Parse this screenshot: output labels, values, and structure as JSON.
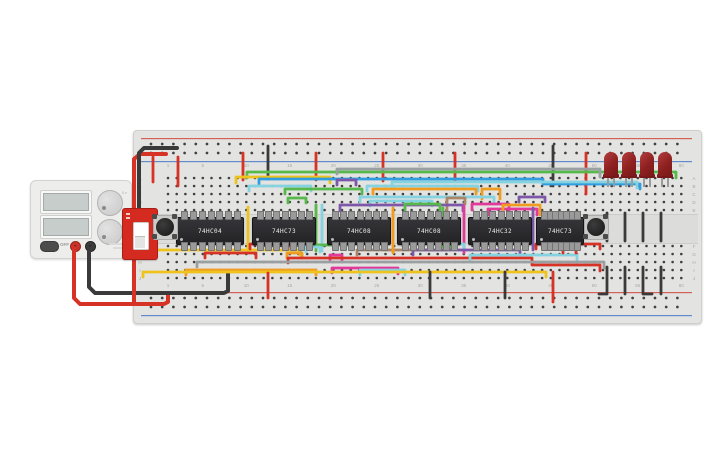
{
  "canvas": {
    "width": 725,
    "height": 453,
    "background": "#ffffff"
  },
  "power_supply": {
    "off_label": "OFF",
    "knobs": [
      {
        "name": "voltage-knob",
        "min": "0 v",
        "max": "30 v"
      },
      {
        "name": "current-knob",
        "min": "0 a",
        "max": "2 a"
      }
    ],
    "screens": [
      {
        "value": ""
      },
      {
        "value": ""
      }
    ],
    "terminals": [
      {
        "name": "positive",
        "color": "#c8322b"
      },
      {
        "name": "negative",
        "color": "#3c3c3c"
      }
    ]
  },
  "slide_switch": {
    "color": "#d42a20",
    "state": "down"
  },
  "board": {
    "column_numbers": [
      1,
      5,
      10,
      15,
      20,
      25,
      30,
      35,
      40,
      45,
      50,
      55,
      60
    ],
    "row_letters_top": [
      "A",
      "B",
      "C",
      "D",
      "E"
    ],
    "row_letters_bottom": [
      "F",
      "G",
      "H",
      "I",
      "J"
    ],
    "rail_plus_color": "#cf4a3f",
    "rail_minus_color": "#4a7bc9"
  },
  "ics": [
    {
      "label": "74HC04",
      "x": 176,
      "w": 66
    },
    {
      "label": "74HC73",
      "x": 252,
      "w": 62
    },
    {
      "label": "74HC08",
      "x": 327,
      "w": 62
    },
    {
      "label": "74HC08",
      "x": 397,
      "w": 62
    },
    {
      "label": "74HC32",
      "x": 468,
      "w": 62
    },
    {
      "label": "74HC73",
      "x": 536,
      "w": 46
    }
  ],
  "pushbuttons": [
    {
      "x": 152
    },
    {
      "x": 583
    }
  ],
  "leds": {
    "color": "#8e2020",
    "x_positions": [
      604,
      622,
      640,
      658
    ]
  },
  "wire_colors": {
    "red": "#d63226",
    "black": "#3a3a3a",
    "yellow": "#eec31e",
    "orange": "#f09c21",
    "green": "#57b94c",
    "blue": "#2f9de0",
    "cyan": "#85d2e0",
    "purple": "#7e57a8",
    "magenta": "#e23a9b",
    "brown": "#ad8566",
    "gray": "#9aa0a2"
  },
  "wires": [
    {
      "c": "red",
      "w": 4,
      "p": [
        [
          74,
          248
        ],
        [
          74,
          298
        ],
        [
          80,
          304
        ],
        [
          164,
          304
        ],
        [
          168,
          302
        ],
        [
          168,
          296
        ]
      ]
    },
    {
      "c": "black",
      "w": 4,
      "p": [
        [
          89,
          248
        ],
        [
          89,
          287
        ],
        [
          95,
          293
        ],
        [
          224,
          293
        ],
        [
          228,
          291
        ],
        [
          228,
          271
        ]
      ]
    },
    {
      "c": "red",
      "w": 4,
      "p": [
        [
          166,
          154
        ],
        [
          140,
          154
        ],
        [
          134,
          159
        ],
        [
          134,
          303
        ]
      ]
    },
    {
      "c": "black",
      "w": 4,
      "p": [
        [
          177,
          148
        ],
        [
          144,
          148
        ],
        [
          139,
          153
        ],
        [
          139,
          254
        ]
      ]
    },
    {
      "c": "red",
      "p": [
        [
          153,
          157
        ],
        [
          153,
          182
        ]
      ]
    },
    {
      "c": "red",
      "p": [
        [
          178,
          157
        ],
        [
          178,
          186
        ]
      ]
    },
    {
      "c": "red",
      "p": [
        [
          243,
          153
        ],
        [
          243,
          180
        ]
      ]
    },
    {
      "c": "red",
      "p": [
        [
          316,
          153
        ],
        [
          316,
          180
        ]
      ]
    },
    {
      "c": "red",
      "p": [
        [
          383,
          153
        ],
        [
          383,
          181
        ]
      ]
    },
    {
      "c": "red",
      "p": [
        [
          455,
          153
        ],
        [
          455,
          181
        ]
      ]
    },
    {
      "c": "red",
      "p": [
        [
          586,
          153
        ],
        [
          586,
          194
        ]
      ]
    },
    {
      "c": "black",
      "p": [
        [
          268,
          146
        ],
        [
          268,
          179
        ]
      ]
    },
    {
      "c": "black",
      "p": [
        [
          553,
          146
        ],
        [
          553,
          186
        ]
      ]
    },
    {
      "c": "green",
      "p": [
        [
          247,
          178
        ],
        [
          247,
          172
        ],
        [
          676,
          172
        ],
        [
          676,
          178
        ]
      ]
    },
    {
      "c": "gray",
      "p": [
        [
          337,
          174
        ],
        [
          337,
          169
        ],
        [
          600,
          169
        ],
        [
          600,
          177
        ]
      ]
    },
    {
      "c": "yellow",
      "p": [
        [
          236,
          183
        ],
        [
          236,
          177
        ],
        [
          330,
          177
        ],
        [
          330,
          183
        ]
      ]
    },
    {
      "c": "blue",
      "p": [
        [
          259,
          185
        ],
        [
          259,
          179
        ],
        [
          543,
          179
        ],
        [
          543,
          184
        ],
        [
          640,
          184
        ],
        [
          640,
          189
        ]
      ]
    },
    {
      "c": "cyan",
      "p": [
        [
          392,
          188
        ],
        [
          392,
          182
        ],
        [
          637,
          182
        ],
        [
          637,
          188
        ]
      ]
    },
    {
      "c": "cyan",
      "p": [
        [
          249,
          191
        ],
        [
          249,
          186
        ],
        [
          311,
          186
        ],
        [
          311,
          191
        ]
      ]
    },
    {
      "c": "green",
      "p": [
        [
          285,
          194
        ],
        [
          285,
          189
        ],
        [
          362,
          189
        ],
        [
          362,
          194
        ]
      ]
    },
    {
      "c": "purple",
      "p": [
        [
          337,
          185
        ],
        [
          337,
          180
        ],
        [
          356,
          180
        ],
        [
          356,
          185
        ]
      ]
    },
    {
      "c": "cyan",
      "p": [
        [
          367,
          191
        ],
        [
          367,
          186
        ],
        [
          478,
          186
        ],
        [
          478,
          191
        ]
      ]
    },
    {
      "c": "orange",
      "p": [
        [
          373,
          194
        ],
        [
          373,
          189
        ],
        [
          476,
          189
        ],
        [
          476,
          194
        ]
      ]
    },
    {
      "c": "orange",
      "p": [
        [
          482,
          199
        ],
        [
          482,
          189
        ],
        [
          500,
          189
        ],
        [
          500,
          199
        ]
      ]
    },
    {
      "c": "cyan",
      "p": [
        [
          360,
          202
        ],
        [
          360,
          197
        ],
        [
          494,
          197
        ],
        [
          494,
          202
        ]
      ]
    },
    {
      "c": "purple",
      "p": [
        [
          519,
          202
        ],
        [
          519,
          197
        ],
        [
          545,
          197
        ],
        [
          545,
          202
        ]
      ]
    },
    {
      "c": "green",
      "p": [
        [
          288,
          203
        ],
        [
          288,
          198
        ],
        [
          306,
          198
        ],
        [
          306,
          203
        ]
      ]
    },
    {
      "c": "cyan",
      "p": [
        [
          370,
          206
        ],
        [
          370,
          201
        ],
        [
          432,
          201
        ],
        [
          432,
          206
        ]
      ]
    },
    {
      "c": "brown",
      "p": [
        [
          465,
          204
        ],
        [
          465,
          198
        ],
        [
          447,
          198
        ],
        [
          447,
          250
        ],
        [
          357,
          250
        ],
        [
          357,
          255
        ]
      ]
    },
    {
      "c": "purple",
      "p": [
        [
          340,
          211
        ],
        [
          340,
          205
        ],
        [
          463,
          205
        ],
        [
          463,
          211
        ]
      ]
    },
    {
      "c": "green",
      "p": [
        [
          405,
          210
        ],
        [
          405,
          204
        ],
        [
          440,
          204
        ],
        [
          440,
          210
        ]
      ]
    },
    {
      "c": "magenta",
      "p": [
        [
          472,
          210
        ],
        [
          472,
          204
        ],
        [
          509,
          204
        ],
        [
          509,
          212
        ]
      ]
    },
    {
      "c": "magenta",
      "p": [
        [
          488,
          215
        ],
        [
          488,
          209
        ],
        [
          537,
          209
        ],
        [
          537,
          215
        ]
      ]
    },
    {
      "c": "orange",
      "p": [
        [
          503,
          215
        ],
        [
          503,
          205
        ],
        [
          540,
          205
        ],
        [
          540,
          215
        ]
      ]
    },
    {
      "c": "yellow",
      "p": [
        [
          248,
          207
        ],
        [
          248,
          251
        ]
      ]
    },
    {
      "c": "green",
      "p": [
        [
          316,
          205
        ],
        [
          316,
          251
        ]
      ]
    },
    {
      "c": "cyan",
      "p": [
        [
          322,
          205
        ],
        [
          322,
          251
        ]
      ]
    },
    {
      "c": "orange",
      "p": [
        [
          393,
          208
        ],
        [
          393,
          253
        ]
      ]
    },
    {
      "c": "green",
      "p": [
        [
          443,
          208
        ],
        [
          443,
          247
        ]
      ]
    },
    {
      "c": "magenta",
      "p": [
        [
          464,
          206
        ],
        [
          464,
          253
        ]
      ]
    },
    {
      "c": "purple",
      "p": [
        [
          533,
          208
        ],
        [
          533,
          250
        ]
      ]
    },
    {
      "c": "yellow",
      "p": [
        [
          143,
          255
        ],
        [
          143,
          250
        ],
        [
          300,
          250
        ],
        [
          300,
          255
        ]
      ]
    },
    {
      "c": "red",
      "p": [
        [
          250,
          249
        ],
        [
          250,
          244
        ],
        [
          288,
          244
        ],
        [
          288,
          249
        ]
      ]
    },
    {
      "c": "green",
      "p": [
        [
          301,
          250
        ],
        [
          301,
          245
        ],
        [
          352,
          245
        ],
        [
          352,
          250
        ]
      ]
    },
    {
      "c": "cyan",
      "p": [
        [
          306,
          252
        ],
        [
          306,
          247
        ],
        [
          320,
          247
        ],
        [
          320,
          252
        ]
      ]
    },
    {
      "c": "cyan",
      "p": [
        [
          420,
          249
        ],
        [
          420,
          244
        ],
        [
          464,
          244
        ],
        [
          464,
          249
        ]
      ]
    },
    {
      "c": "green",
      "p": [
        [
          437,
          250
        ],
        [
          437,
          245
        ],
        [
          450,
          245
        ],
        [
          450,
          250
        ]
      ]
    },
    {
      "c": "red",
      "p": [
        [
          536,
          249
        ],
        [
          536,
          244
        ],
        [
          600,
          244
        ],
        [
          600,
          249
        ]
      ]
    },
    {
      "c": "red",
      "p": [
        [
          205,
          258
        ],
        [
          205,
          253
        ],
        [
          256,
          253
        ],
        [
          256,
          258
        ]
      ]
    },
    {
      "c": "orange",
      "p": [
        [
          287,
          258
        ],
        [
          287,
          253
        ],
        [
          302,
          253
        ],
        [
          302,
          258
        ]
      ]
    },
    {
      "c": "magenta",
      "p": [
        [
          330,
          260
        ],
        [
          330,
          255
        ],
        [
          342,
          255
        ],
        [
          342,
          260
        ]
      ]
    },
    {
      "c": "purple",
      "p": [
        [
          413,
          255
        ],
        [
          413,
          250
        ],
        [
          520,
          250
        ],
        [
          520,
          255
        ]
      ]
    },
    {
      "c": "red",
      "p": [
        [
          288,
          263
        ],
        [
          288,
          258
        ],
        [
          532,
          258
        ],
        [
          532,
          265
        ],
        [
          600,
          265
        ],
        [
          600,
          271
        ]
      ]
    },
    {
      "c": "cyan",
      "p": [
        [
          470,
          260
        ],
        [
          470,
          255
        ],
        [
          577,
          255
        ],
        [
          577,
          260
        ]
      ]
    },
    {
      "c": "red",
      "p": [
        [
          563,
          253
        ],
        [
          563,
          249
        ],
        [
          576,
          249
        ],
        [
          576,
          253
        ]
      ]
    },
    {
      "c": "gray",
      "p": [
        [
          197,
          267
        ],
        [
          197,
          262
        ],
        [
          604,
          262
        ],
        [
          604,
          268
        ]
      ]
    },
    {
      "c": "magenta",
      "p": [
        [
          332,
          273
        ],
        [
          332,
          268
        ],
        [
          398,
          268
        ],
        [
          398,
          274
        ]
      ]
    },
    {
      "c": "cyan",
      "p": [
        [
          360,
          275
        ],
        [
          360,
          270
        ],
        [
          405,
          270
        ],
        [
          405,
          275
        ]
      ]
    },
    {
      "c": "orange",
      "p": [
        [
          186,
          275
        ],
        [
          186,
          270
        ],
        [
          316,
          270
        ],
        [
          316,
          275
        ]
      ]
    },
    {
      "c": "yellow",
      "p": [
        [
          143,
          277
        ],
        [
          143,
          272
        ],
        [
          546,
          272
        ],
        [
          546,
          277
        ]
      ]
    },
    {
      "c": "red",
      "p": [
        [
          268,
          273
        ],
        [
          268,
          298
        ]
      ]
    },
    {
      "c": "black",
      "p": [
        [
          430,
          272
        ],
        [
          430,
          298
        ]
      ]
    },
    {
      "c": "black",
      "p": [
        [
          505,
          272
        ],
        [
          505,
          298
        ]
      ]
    },
    {
      "c": "red",
      "p": [
        [
          553,
          272
        ],
        [
          553,
          302
        ]
      ]
    },
    {
      "c": "black",
      "p": [
        [
          607,
          213
        ],
        [
          607,
          241
        ]
      ]
    },
    {
      "c": "black",
      "p": [
        [
          625,
          213
        ],
        [
          625,
          241
        ]
      ]
    },
    {
      "c": "black",
      "p": [
        [
          643,
          213
        ],
        [
          643,
          241
        ]
      ]
    },
    {
      "c": "black",
      "p": [
        [
          661,
          213
        ],
        [
          661,
          241
        ]
      ]
    },
    {
      "c": "black",
      "p": [
        [
          607,
          267
        ],
        [
          607,
          294
        ],
        [
          599,
          294
        ]
      ]
    },
    {
      "c": "black",
      "p": [
        [
          625,
          267
        ],
        [
          625,
          294
        ]
      ]
    },
    {
      "c": "black",
      "p": [
        [
          643,
          267
        ],
        [
          643,
          294
        ],
        [
          652,
          294
        ]
      ]
    },
    {
      "c": "black",
      "p": [
        [
          661,
          267
        ],
        [
          661,
          294
        ]
      ]
    }
  ]
}
